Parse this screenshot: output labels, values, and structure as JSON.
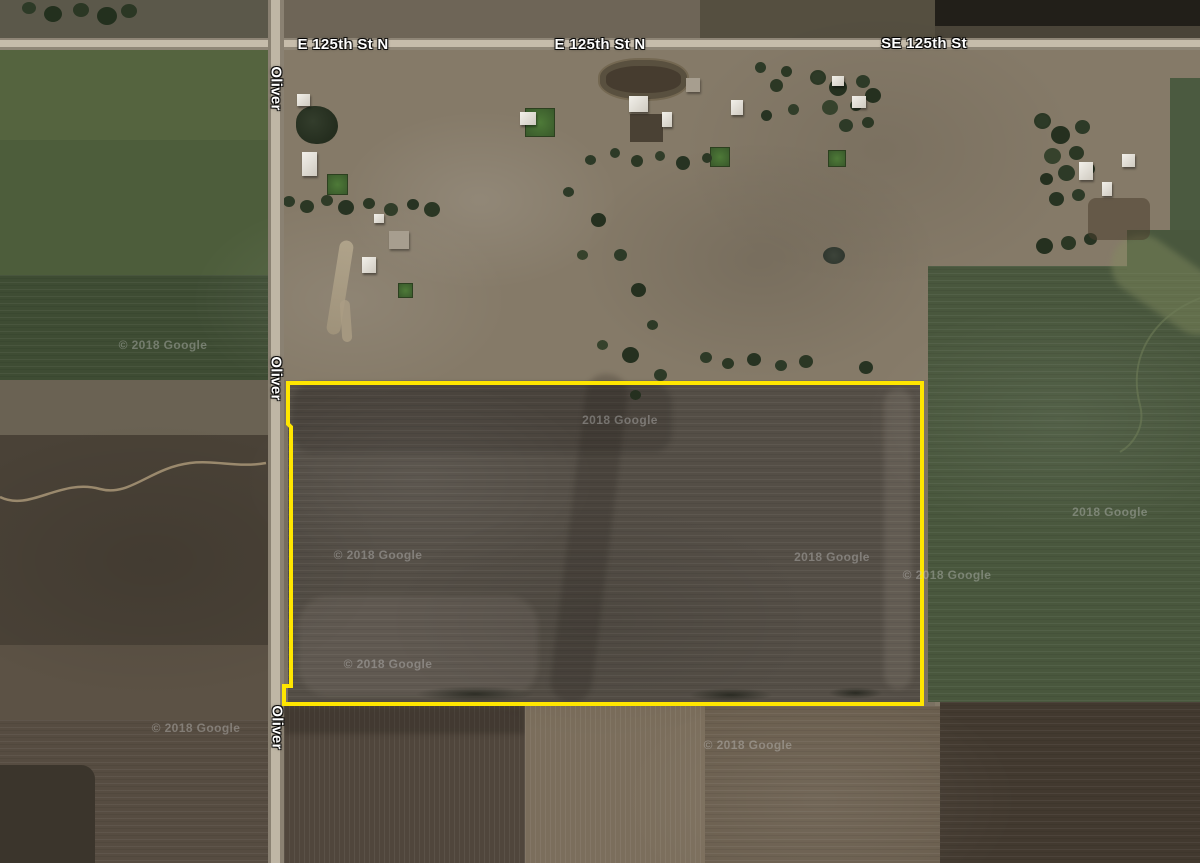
{
  "map": {
    "imagery_credit": "© 2018 Google",
    "parcel_outline_color": "#ffe600"
  },
  "road_labels": {
    "horizontal": [
      {
        "text": "E 125th St N"
      },
      {
        "text": "E 125th St N"
      },
      {
        "text": "SE 125th St"
      }
    ],
    "vertical": [
      {
        "text": "Oliver"
      },
      {
        "text": "Oliver"
      },
      {
        "text": "Oliver"
      }
    ]
  },
  "watermarks": [
    {
      "text": "© 2018 Google"
    },
    {
      "text": "2018 Google"
    },
    {
      "text": "© 2018 Google"
    },
    {
      "text": "2018 Google"
    },
    {
      "text": "© 2018 Google"
    },
    {
      "text": "2018 Google"
    },
    {
      "text": "© 2018 Google"
    },
    {
      "text": "© 2018 Google"
    },
    {
      "text": "© 2018 Google"
    }
  ]
}
